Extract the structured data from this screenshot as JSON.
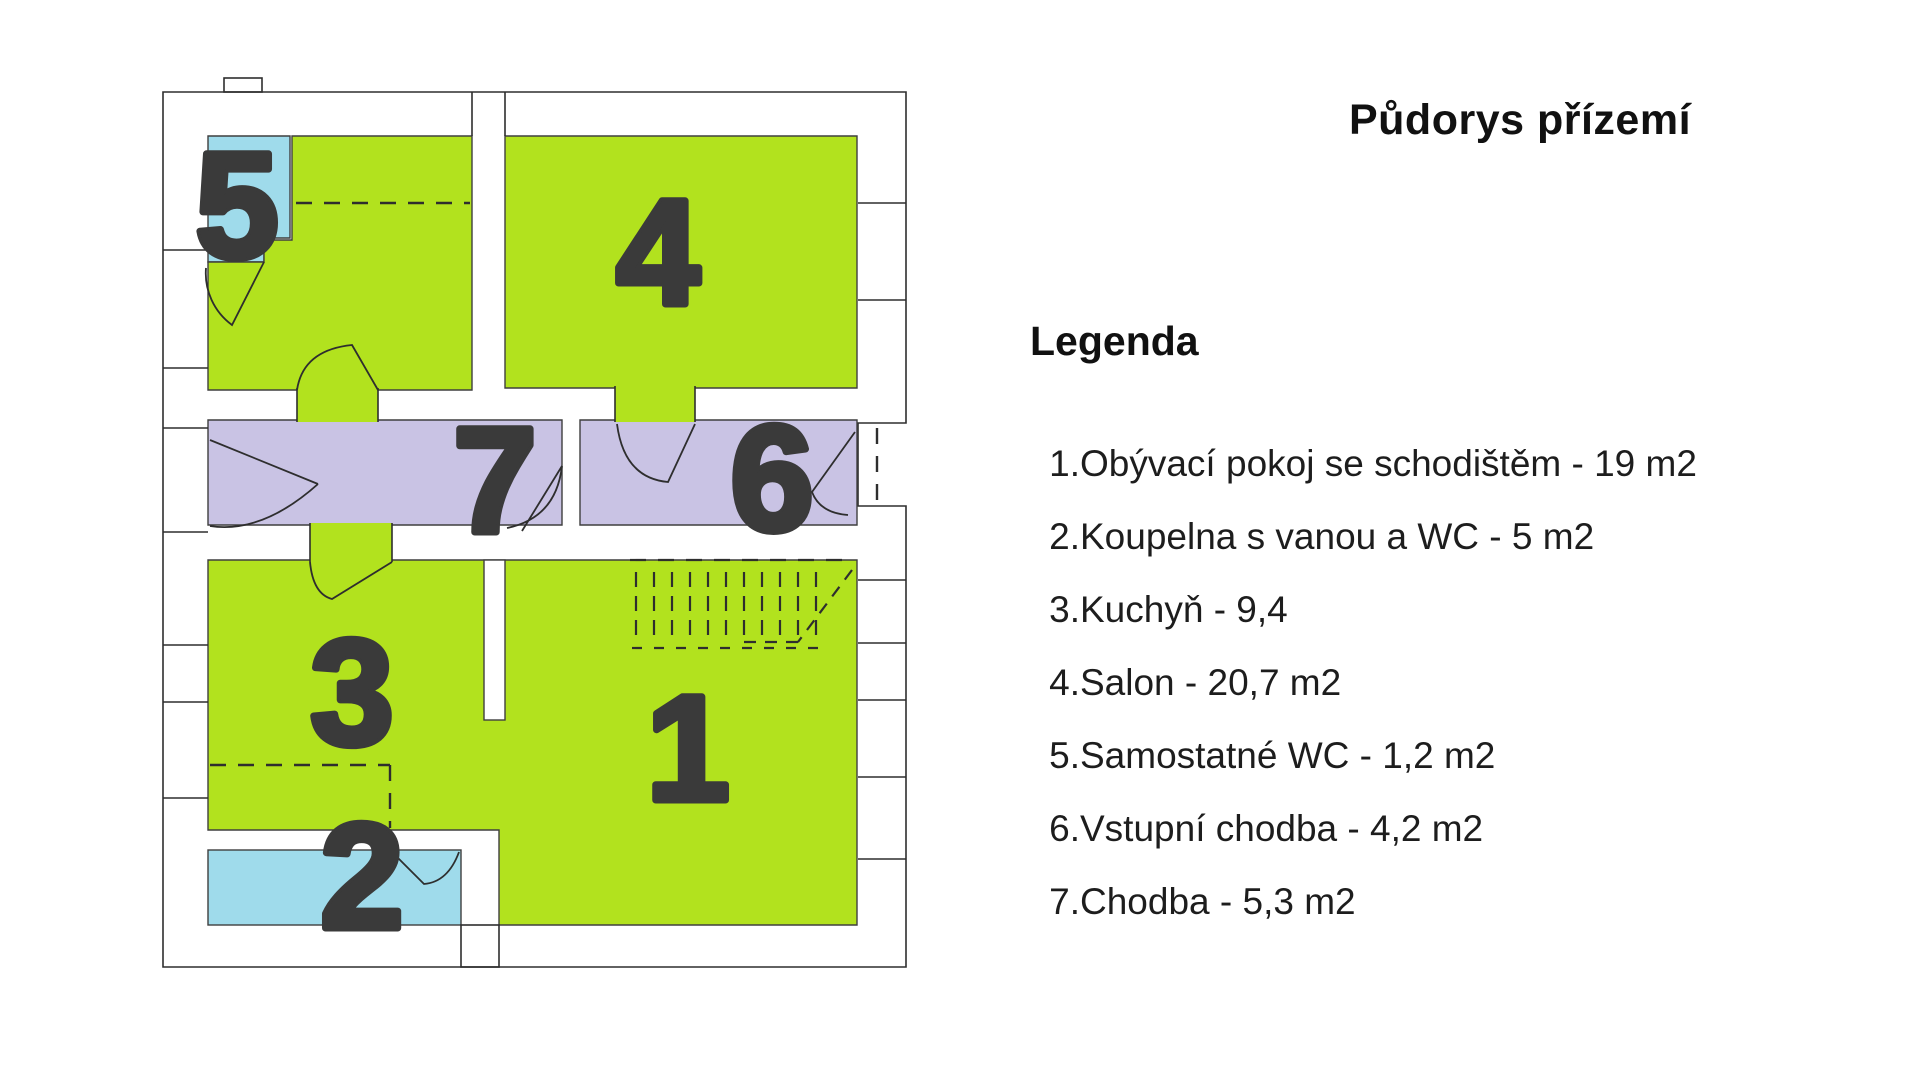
{
  "title": "Půdorys přízemí",
  "legend": {
    "heading": "Legenda",
    "items": [
      {
        "num": "1.",
        "label": "Obývací pokoj se schodištěm - 19 m2"
      },
      {
        "num": "2.",
        "label": "Koupelna s vanou a WC - 5 m2"
      },
      {
        "num": "3.",
        "label": "Kuchyň - 9,4"
      },
      {
        "num": "4.",
        "label": "Salon - 20,7 m2"
      },
      {
        "num": "5.",
        "label": "Samostatné WC - 1,2 m2"
      },
      {
        "num": "6.",
        "label": "Vstupní chodba - 4,2 m2"
      },
      {
        "num": "7.",
        "label": "Chodba - 5,3 m2"
      }
    ]
  },
  "rooms": [
    {
      "number": "1",
      "name": "Obývací pokoj se schodištěm",
      "area": "19 m2"
    },
    {
      "number": "2",
      "name": "Koupelna s vanou a WC",
      "area": "5 m2"
    },
    {
      "number": "3",
      "name": "Kuchyň",
      "area": "9,4"
    },
    {
      "number": "4",
      "name": "Salon",
      "area": "20,7 m2"
    },
    {
      "number": "5",
      "name": "Samostatné WC",
      "area": "1,2 m2"
    },
    {
      "number": "6",
      "name": "Vstupní chodba",
      "area": "4,2 m2"
    },
    {
      "number": "7",
      "name": "Chodba",
      "area": "5,3 m2"
    }
  ],
  "colors": {
    "room_green": "#b2e21e",
    "room_blue": "#9fdbeb",
    "room_purple": "#c9c3e4",
    "wall_line": "#2e2e2e",
    "number_text": "#3a3a3a"
  }
}
